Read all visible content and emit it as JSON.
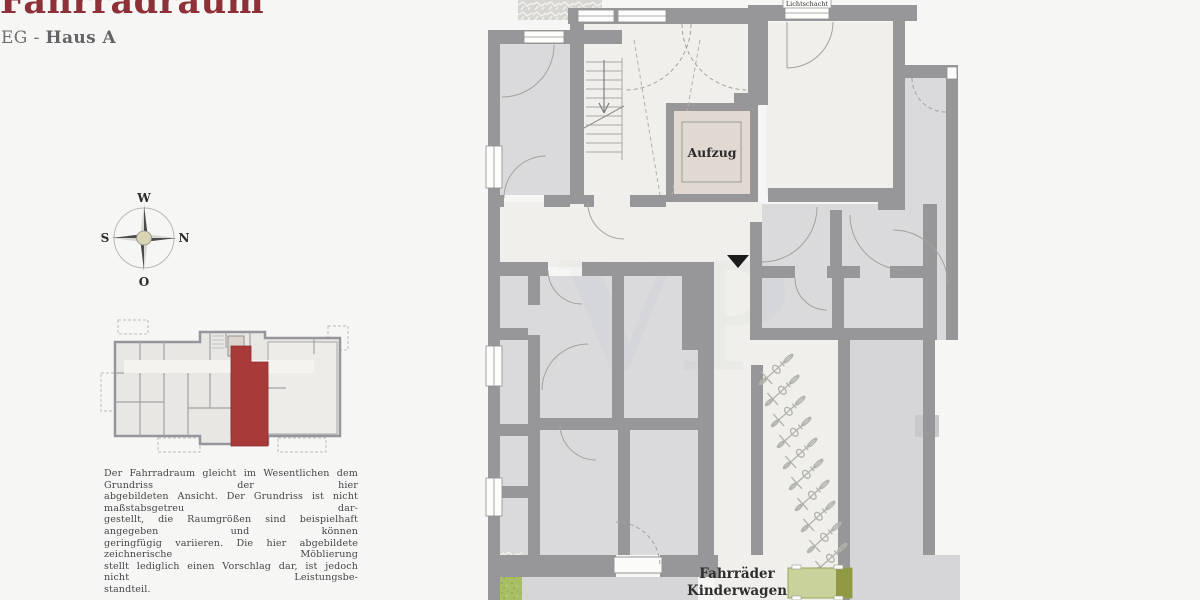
{
  "header": {
    "title": "Fahrradraum",
    "subtitle_prefix": "EG - ",
    "subtitle_bold": "Haus A"
  },
  "compass": {
    "west": "W",
    "north": "N",
    "east": "O",
    "south": "S"
  },
  "overview": {
    "highlight_color": "#a93a3a"
  },
  "disclaimer": {
    "lines": [
      "Der Fahrradraum gleicht im Wesentlichen dem Grundriss der hier",
      "abgebildeten Ansicht. Der Grundriss ist nicht maßstabsgetreu dar-",
      "gestellt, die Raumgrößen sind beispielhaft angegeben und können",
      "geringfügig variieren. Die hier abgebildete zeichnerische Möblierung",
      "stellt lediglich einen Vorschlag dar, ist jedoch nicht Leistungsbe-",
      "standteil."
    ]
  },
  "plan": {
    "labels": {
      "elevator": "Aufzug",
      "light_shaft": "Lichtschacht",
      "room_line1": "Fahrräder",
      "room_line2": "Kinderwagen"
    },
    "watermark": "VP",
    "colors": {
      "wall": "#97979a",
      "floor_light": "#f0efeb",
      "floor_gray": "#dadadc",
      "elevator_interior": "#e2d8d2",
      "furniture_green": "#c8d29a",
      "grass": "#a9bf63",
      "highlight_red": "#a93a3a"
    },
    "bike_count": 10
  }
}
